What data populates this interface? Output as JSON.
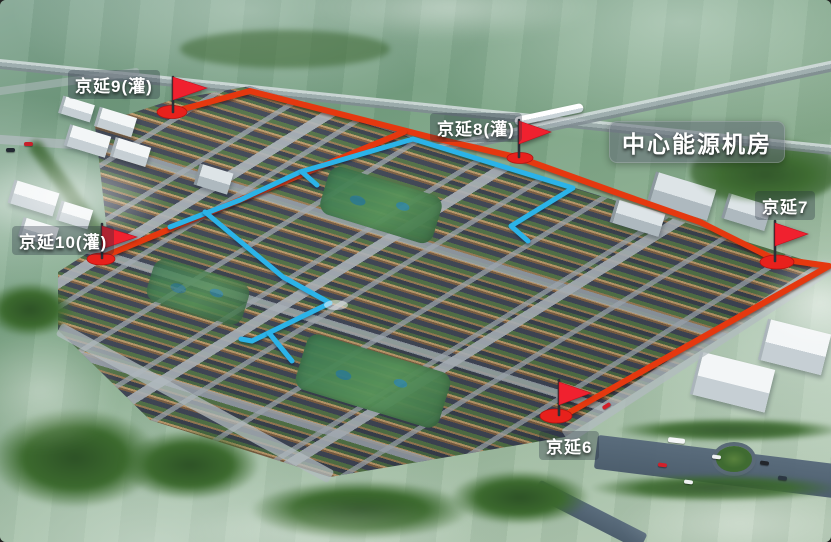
{
  "markers": [
    {
      "id": "jingyan-9",
      "label": "京延9(灌)",
      "icon": "flag"
    },
    {
      "id": "jingyan-8",
      "label": "京延8(灌)",
      "icon": "flag"
    },
    {
      "id": "central-energy-plant",
      "label": "中心能源机房",
      "icon": "none"
    },
    {
      "id": "jingyan-7",
      "label": "京延7",
      "icon": "flag"
    },
    {
      "id": "jingyan-10",
      "label": "京延10(灌)",
      "icon": "flag"
    },
    {
      "id": "jingyan-6",
      "label": "京延6",
      "icon": "flag"
    }
  ],
  "colors": {
    "route_red": "#e5380f",
    "route_blue": "#2bb3e8",
    "flag_red": "#f0212f",
    "marker_base_red": "#e8211c",
    "label_text": "#ffffff",
    "label_bg": "rgba(35,45,58,0.32)",
    "center_label_bg": "rgba(98,108,118,0.55)"
  }
}
